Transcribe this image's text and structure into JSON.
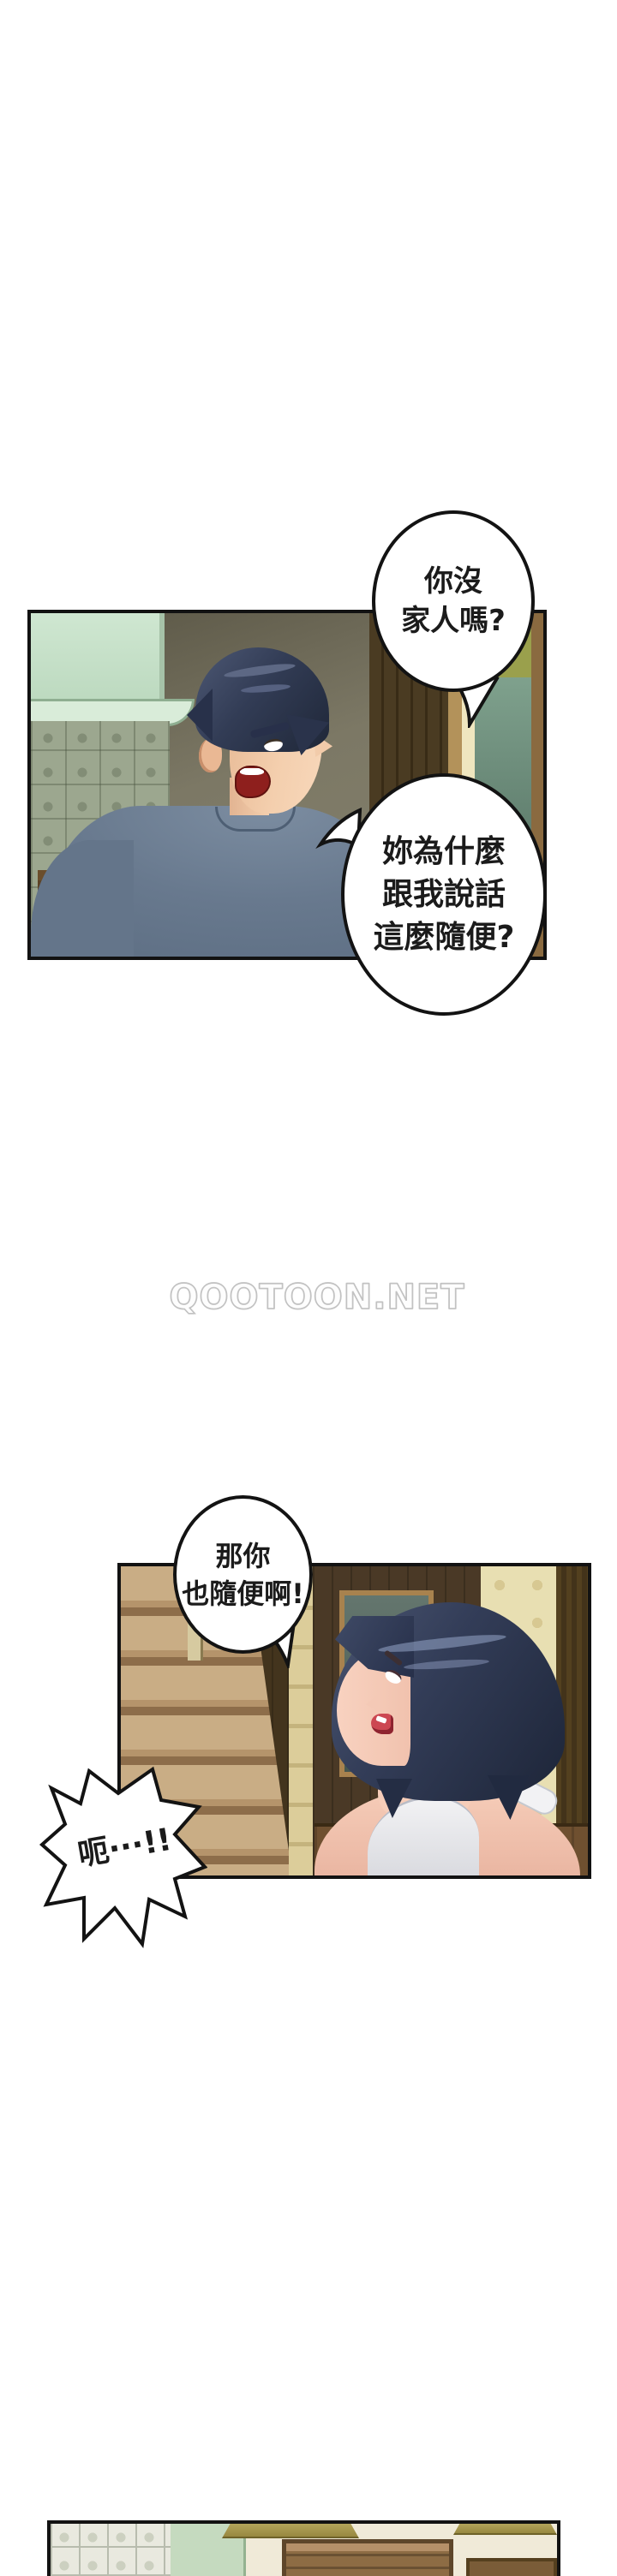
{
  "page": {
    "watermark": "QOOTOON.NET",
    "background_color": "#ffffff"
  },
  "speech": {
    "bubble1": {
      "lines": [
        "你沒",
        "家人嗎?"
      ]
    },
    "bubble2": {
      "lines": [
        "妳為什麼",
        "跟我說話",
        "這麼隨便?"
      ]
    },
    "bubble3": {
      "lines": [
        "那你",
        "也隨便啊!"
      ]
    },
    "burst": {
      "text": "呃···!!"
    }
  },
  "colors": {
    "panel_border": "#121212",
    "bubble_border": "#131313",
    "man_shirt": "#68798e",
    "character_hair": "#323c55",
    "skin": "#f4cfae",
    "dark_wood": "#43341d",
    "teal_door_panel": "#5d6f68",
    "mint_cabinet": "#cfe7d1",
    "stairs_wood": "#c9ad85",
    "watermark_outline": "#c2c2c2"
  }
}
